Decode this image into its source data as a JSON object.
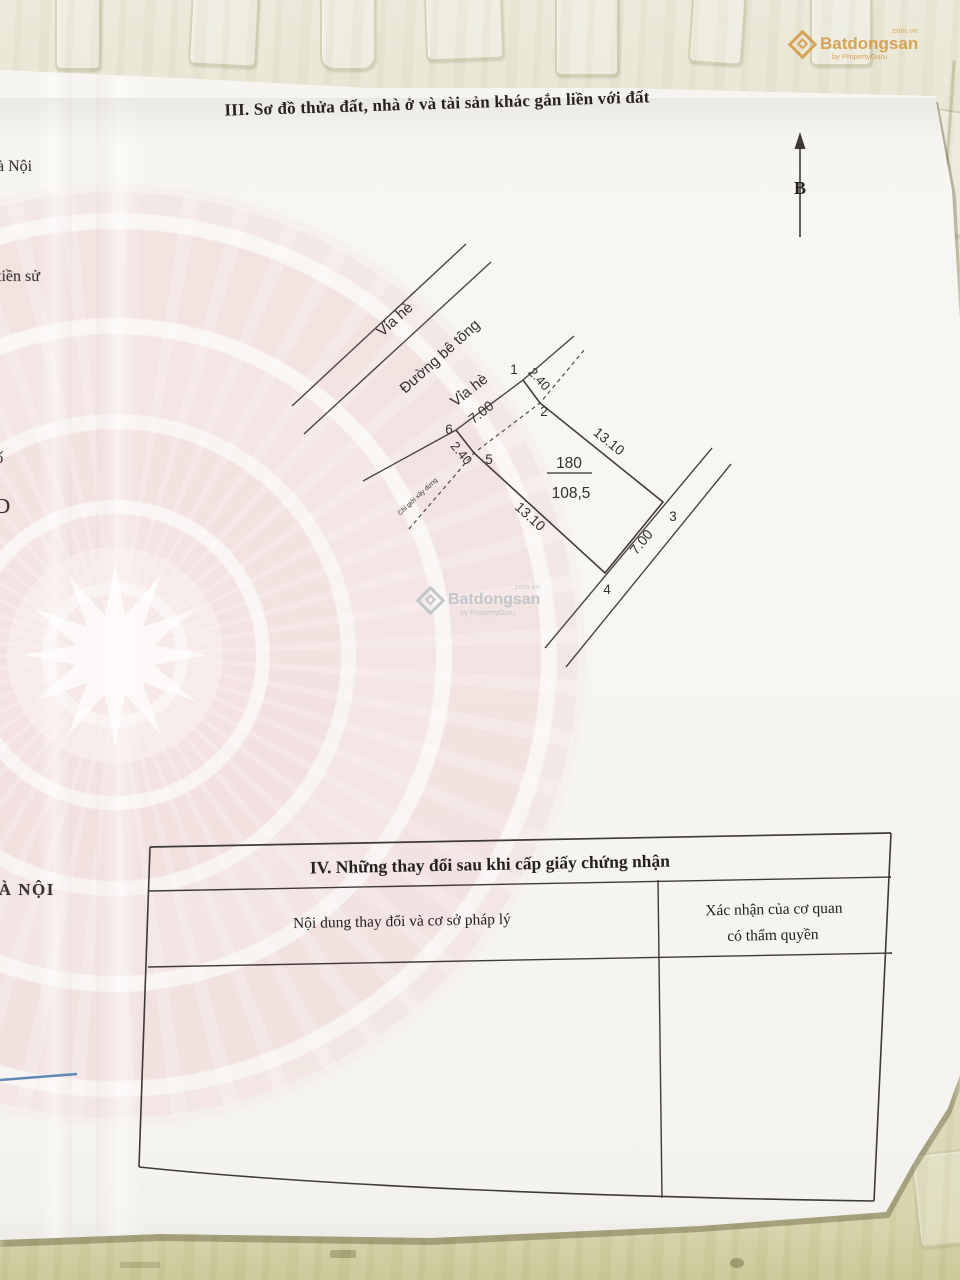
{
  "section3": {
    "title": "III. Sơ đồ thửa đất, nhà ở và tài sản khác gắn liền với đất"
  },
  "north": {
    "label": "B"
  },
  "diagram": {
    "sidewalk_top": "Vỉa hè",
    "road": "Đường bê tông",
    "sidewalk_front": "Vỉa hè",
    "construction_line": "Chỉ giới xây dựng",
    "parcel_number": "180",
    "parcel_area": "108,5",
    "len_front": "7.00",
    "len_right": "13.10",
    "len_back": "7.00",
    "len_left": "13.10",
    "setback_left": "2.40",
    "setback_right": "2.40",
    "v1": "1",
    "v2": "2",
    "v3": "3",
    "v4": "4",
    "v5": "5",
    "v6": "6"
  },
  "table4": {
    "title": "IV. Những thay đổi sau khi cấp giấy chứng nhận",
    "col_content": "Nội dung thay đổi và cơ sở pháp lý",
    "col_confirm_line1": "Xác nhận của cơ quan",
    "col_confirm_line2": "có thẩm quyền"
  },
  "fragments": {
    "f1": "à Nội",
    "f2": ")",
    "f3": "tiền sử",
    "f4": "số",
    "f5": "D",
    "f6": "HÀ NỘI"
  },
  "watermark": {
    "top": ".com.vn",
    "brand": "Batdongsan",
    "byline": "by PropertyGuru"
  },
  "colors": {
    "wall_top": "#e8e5d4",
    "wall_bottom": "#d0cc9c",
    "paper": "#f7f6f3",
    "emblem_pink": "#eecdcd",
    "ink": "#33302e",
    "line": "#44403e",
    "blue_line": "#4f7db3",
    "watermark_orange": "#d2943a",
    "watermark_gray": "#bac0c6"
  }
}
